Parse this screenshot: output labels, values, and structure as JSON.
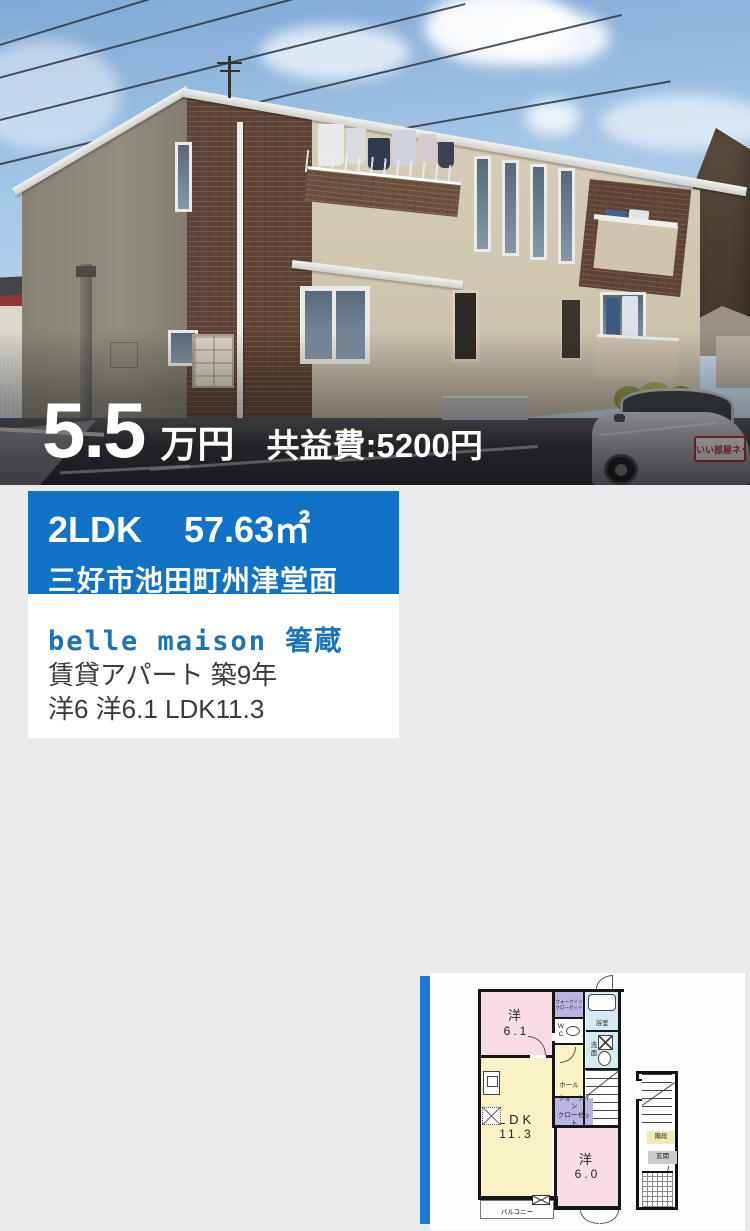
{
  "colors": {
    "accent_blue": "#1173c8",
    "name_blue": "#1b74ba",
    "floorplan_bar_blue": "#1e7ad3"
  },
  "photo": {
    "price": {
      "amount": "5.5",
      "unit": "万円",
      "maintenance_fee": "共益費:5200円"
    },
    "car_sign": "いい部屋ネット"
  },
  "listing": {
    "layout": "2LDK",
    "area": "57.63㎡",
    "address": "三好市池田町州津堂面",
    "name": "belle maison 箸蔵",
    "type_age": "賃貸アパート 築9年",
    "rooms_summary": "洋6 洋6.1 LDK11.3"
  },
  "floorplan": {
    "west1": {
      "label": "洋",
      "size": "6.1"
    },
    "wic1": {
      "l1": "ウォークイン",
      "l2": "クローゼット"
    },
    "wc": {
      "l1": "W",
      "l2": "C"
    },
    "bath": "浴室",
    "wash": {
      "l1": "洗",
      "l2": "面"
    },
    "hall": "ホール",
    "wic2": {
      "l1": "ウォークイン",
      "l2": "クローゼット"
    },
    "ldk": {
      "label": "LDK",
      "size": "11.3"
    },
    "west2": {
      "label": "洋",
      "size": "6.0"
    },
    "balcony": "バルコニー",
    "stairs": "階段",
    "entrance": "玄関"
  }
}
